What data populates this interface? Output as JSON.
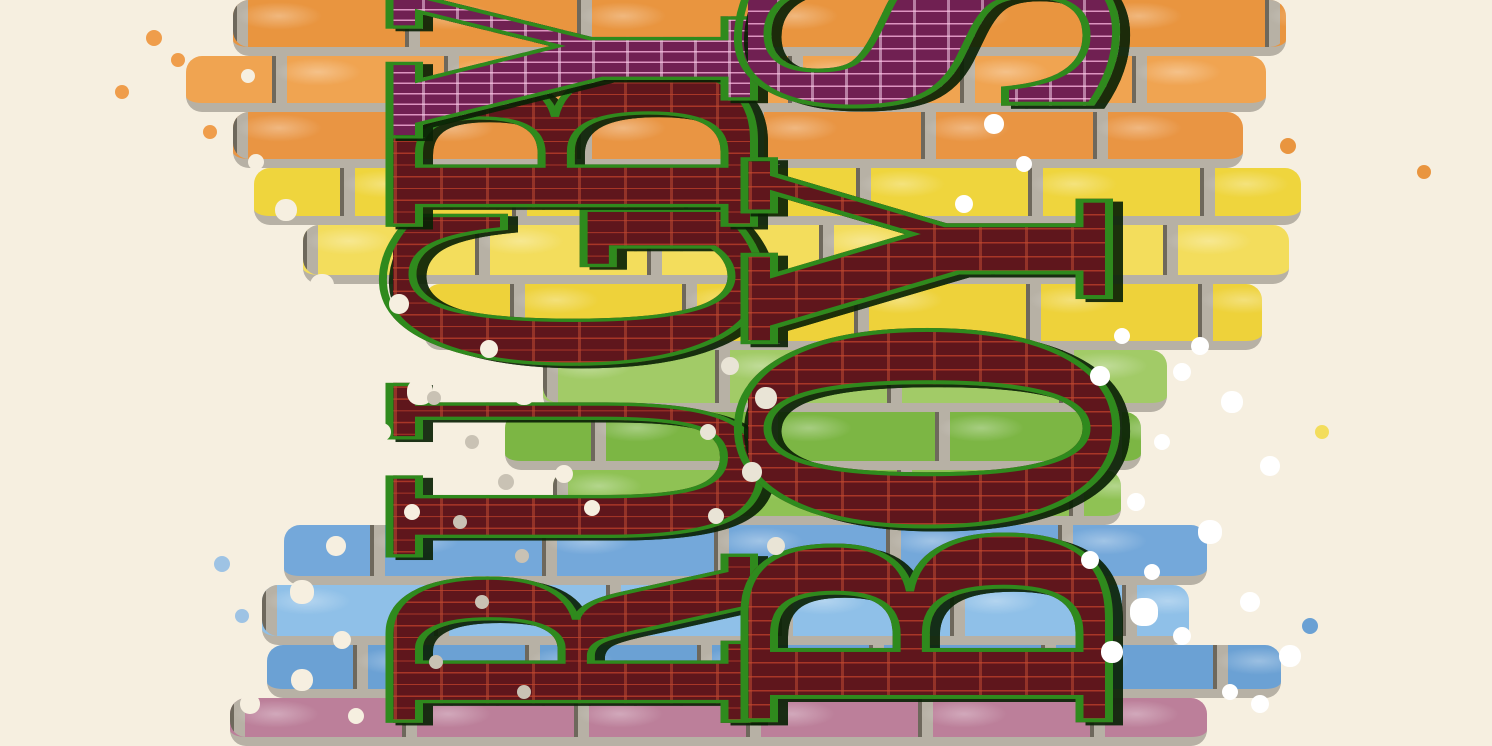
{
  "artwork": {
    "type": "graffiti mural poster",
    "description": "Dark red block letters filled with brownstone-facade line art, outlined in green and rotated 90 degrees counterclockwise, spray-painted over a rainbow-striped brick wall on a cream background",
    "orientation": "letters read bottom-to-top; top letters are cropped by the image edge",
    "text_columns": [
      {
        "id": "left",
        "word": "RUGBY",
        "reading": "bottom-to-top",
        "letters": [
          {
            "char": "R",
            "style": "maroon",
            "offset": 2
          },
          {
            "char": "U",
            "style": "maroon",
            "offset": 170
          },
          {
            "char": "G",
            "style": "maroon",
            "offset": 360
          },
          {
            "char": "B",
            "style": "maroon",
            "offset": 498
          },
          {
            "char": "Y",
            "style": "magenta",
            "offset": 598
          }
        ]
      },
      {
        "id": "right",
        "word": "BOYS",
        "reading": "bottom-to-top",
        "letters": [
          {
            "char": "B",
            "style": "maroon",
            "offset": 3
          },
          {
            "char": "O",
            "style": "maroon",
            "offset": 198
          },
          {
            "char": "Y",
            "style": "maroon",
            "offset": 395
          },
          {
            "char": "S",
            "style": "magenta",
            "offset": 612
          }
        ]
      }
    ],
    "palette": {
      "background_cream": "#f6efe0",
      "letter_maroon": "#5f161c",
      "letter_line_red": "#a93627",
      "letter_magenta": "#702052",
      "letter_line_pink": "#dd94c0",
      "outline_green": "#2f8a1d",
      "shadow_dark": "#0a2205",
      "mortar_gray": "#b7b1a5"
    }
  },
  "wall": {
    "mortar": "#b7b1a5",
    "rows": [
      {
        "y": 0,
        "h": 56,
        "color": "#e9953f",
        "left": 233,
        "right": 1286
      },
      {
        "y": 56,
        "h": 56,
        "color": "#f0a451",
        "left": 186,
        "right": 1266
      },
      {
        "y": 112,
        "h": 56,
        "color": "#e99543",
        "left": 233,
        "right": 1243
      },
      {
        "y": 168,
        "h": 57,
        "color": "#efd53d",
        "left": 254,
        "right": 1301
      },
      {
        "y": 225,
        "h": 59,
        "color": "#f3dd5c",
        "left": 303,
        "right": 1289
      },
      {
        "y": 284,
        "h": 66,
        "color": "#eed23a",
        "left": 424,
        "right": 1262
      },
      {
        "y": 350,
        "h": 62,
        "color": "#a2cb67",
        "left": 543,
        "right": 1167
      },
      {
        "y": 412,
        "h": 58,
        "color": "#7cb644",
        "left": 505,
        "right": 1141
      },
      {
        "y": 470,
        "h": 55,
        "color": "#8fc254",
        "left": 553,
        "right": 1121
      },
      {
        "y": 525,
        "h": 60,
        "color": "#74a8da",
        "left": 284,
        "right": 1207
      },
      {
        "y": 585,
        "h": 60,
        "color": "#8fc0e8",
        "left": 262,
        "right": 1189
      },
      {
        "y": 645,
        "h": 53,
        "color": "#6ba1d4",
        "left": 267,
        "right": 1281
      },
      {
        "y": 698,
        "h": 48,
        "color": "#bc7f9a",
        "left": 230,
        "right": 1207
      }
    ]
  }
}
